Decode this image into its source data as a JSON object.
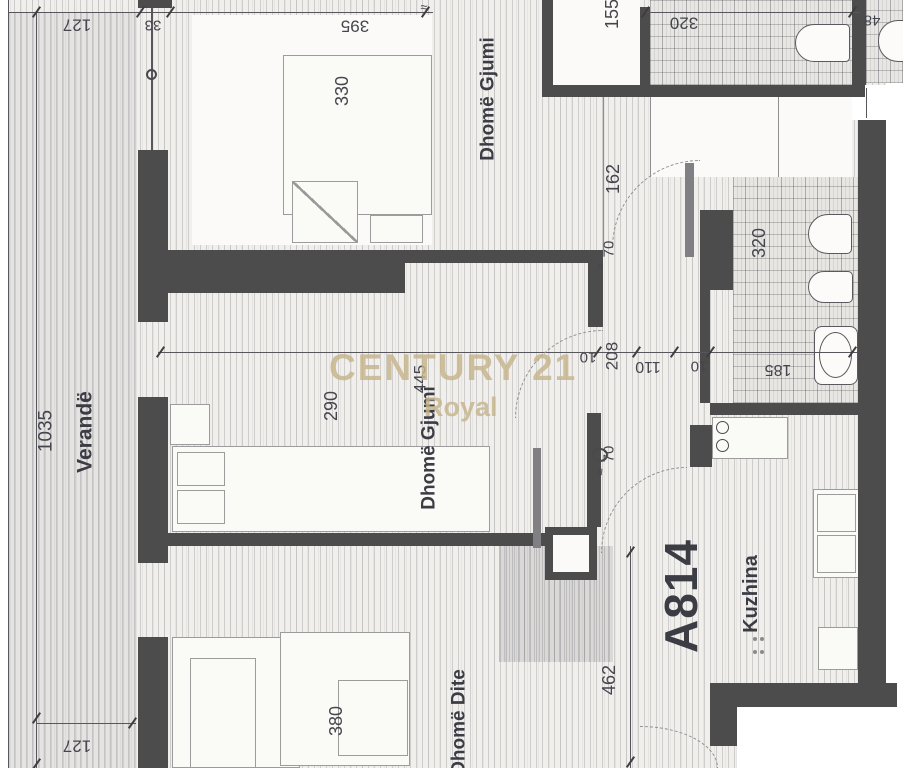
{
  "floorplan": {
    "apartment_number": "A814",
    "watermark": {
      "brand": "CENTURY 21",
      "agency": "Royal"
    },
    "rooms": {
      "veranda": "Verandë",
      "bedroom_top": "Dhomë Gjumi",
      "bedroom_middle": "Dhomë Gjumi",
      "living_room": "Dhomë Dite",
      "kitchen": "Kuzhina"
    },
    "dims": {
      "top_left_127": "127",
      "top_33": "33",
      "top_395": "395",
      "top_155": "155",
      "top_320": "320",
      "top_right_48": "48",
      "left_1035": "1035",
      "bedroom_top_330": "330",
      "hall_162": "162",
      "bedroom_mid_290": "290",
      "bedroom_mid_445": "445",
      "hall_208": "208",
      "hall_110": "110",
      "hall_10_left": "10",
      "hall_10_right": "10",
      "bath_185": "185",
      "bath_320": "320",
      "door_70_top": "70",
      "door_70_bottom": "70",
      "living_380": "380",
      "entry_462": "462",
      "bottom_left_127": "127"
    },
    "marks": {
      "approx": "≈"
    },
    "colors": {
      "wall": "#4c4c4c",
      "watermark": "#c6b48b",
      "label_text": "#3c3c45",
      "dim_text": "#45454d"
    }
  }
}
